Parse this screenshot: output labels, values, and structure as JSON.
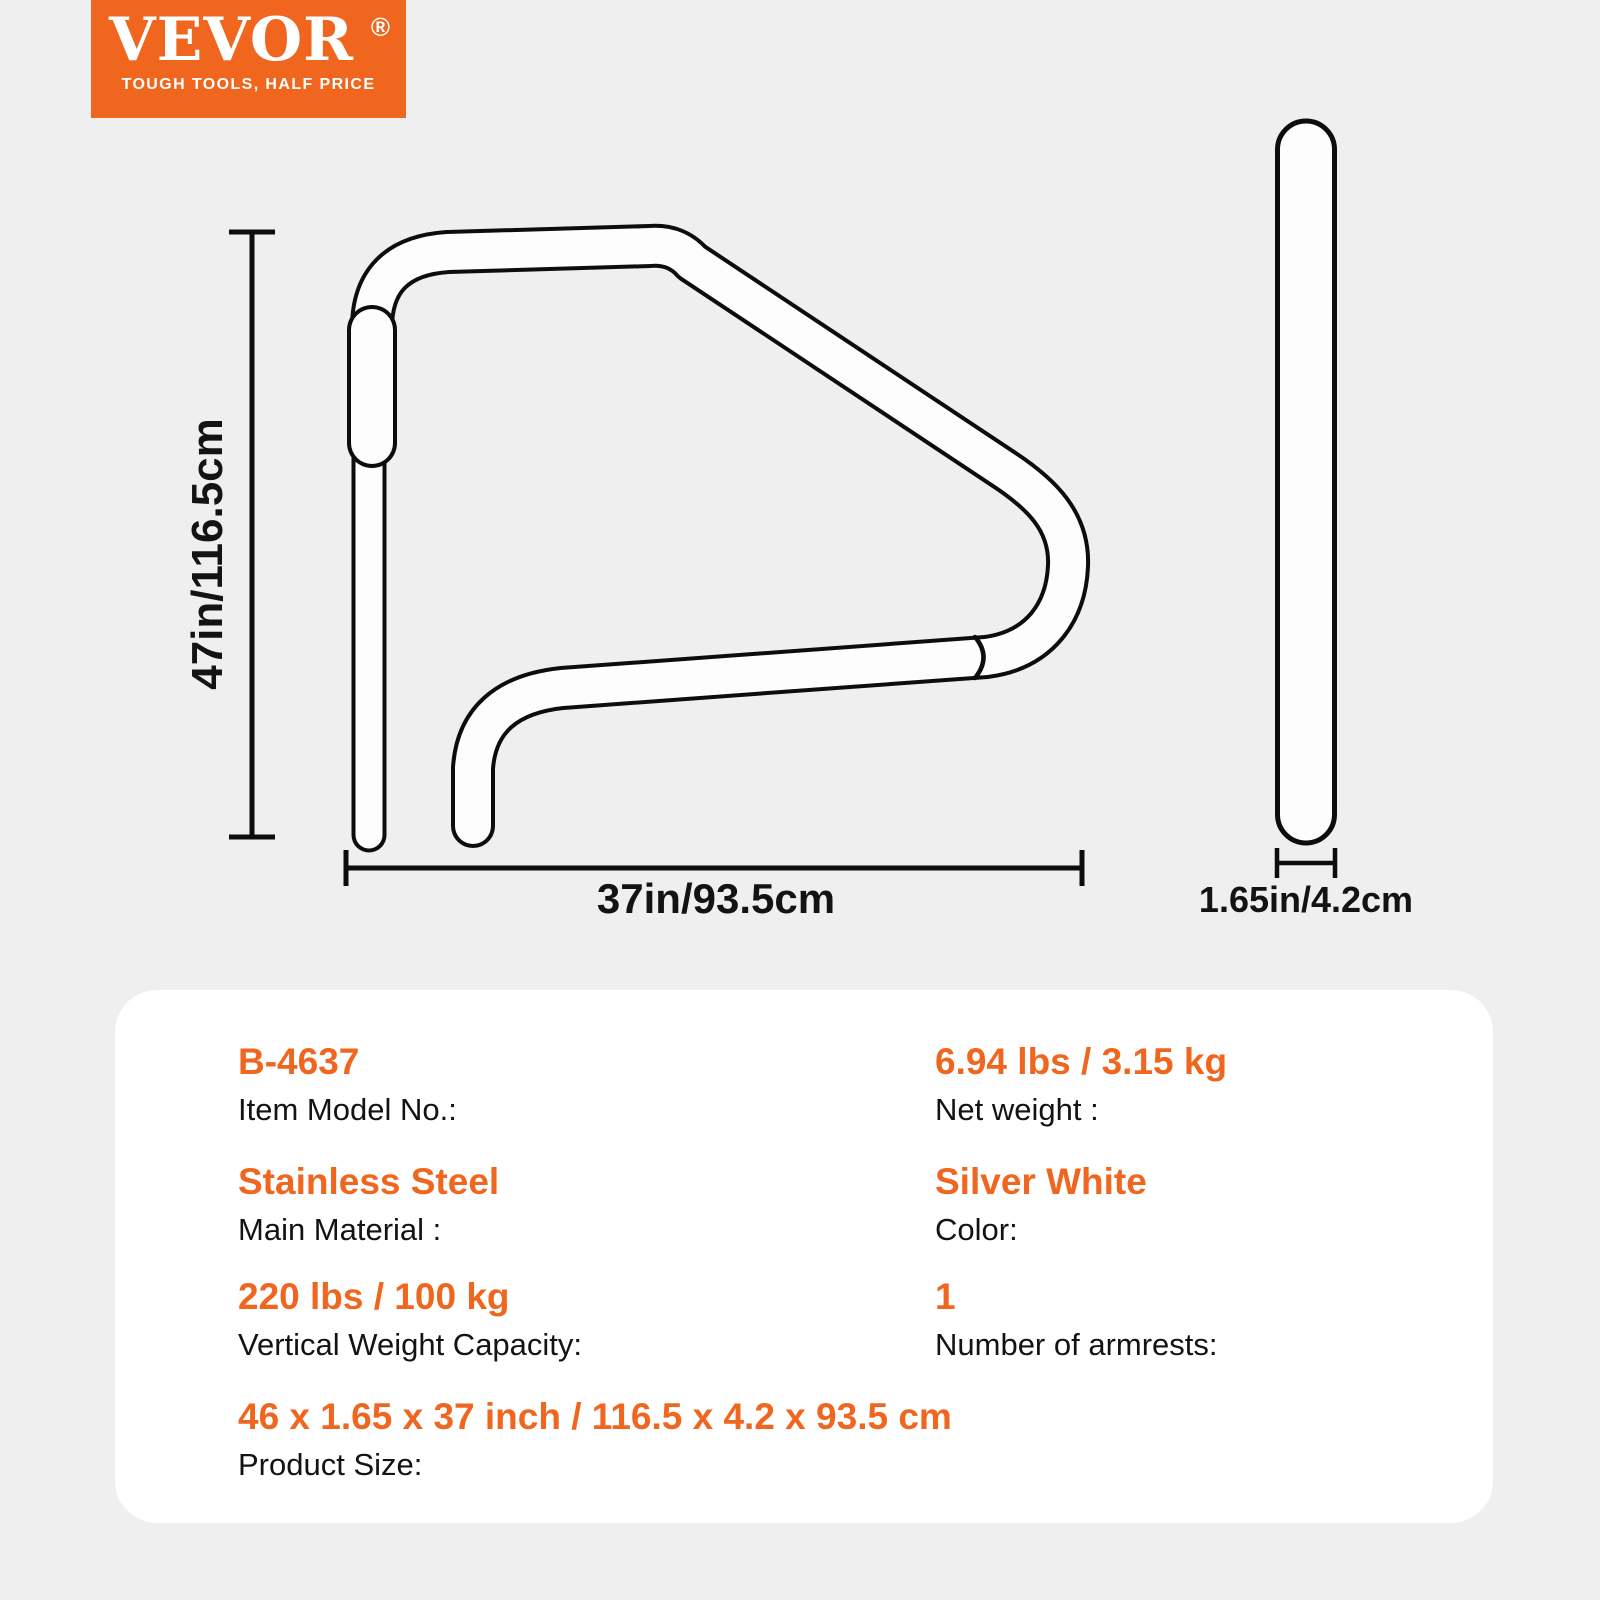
{
  "colors": {
    "accent": "#F0661F",
    "background": "#EFEFF0",
    "panel": "#FFFFFF",
    "ink": "#131313",
    "line": "#0D0D0D",
    "tube_fill": "#FDFDFD"
  },
  "logo": {
    "brand": "VEVOR",
    "registered_mark": "®",
    "tagline": "TOUGH TOOLS, HALF PRICE"
  },
  "diagram": {
    "front_view": {
      "height_label": "47in/116.5cm",
      "width_label": "37in/93.5cm"
    },
    "side_view": {
      "width_label": "1.65in/4.2cm"
    }
  },
  "specs": {
    "rows": [
      {
        "value": "B-4637",
        "label": "Item Model No.:"
      },
      {
        "value": "6.94 lbs / 3.15 kg",
        "label": "Net weight :"
      },
      {
        "value": "Stainless Steel",
        "label": "Main Material :"
      },
      {
        "value": "Silver White",
        "label": "Color:"
      },
      {
        "value": "220 lbs / 100 kg",
        "label": "Vertical Weight Capacity:"
      },
      {
        "value": "1",
        "label": "Number of armrests:"
      },
      {
        "value": "46 x 1.65 x 37 inch / 116.5 x 4.2 x 93.5 cm",
        "label": "Product Size:"
      }
    ]
  }
}
